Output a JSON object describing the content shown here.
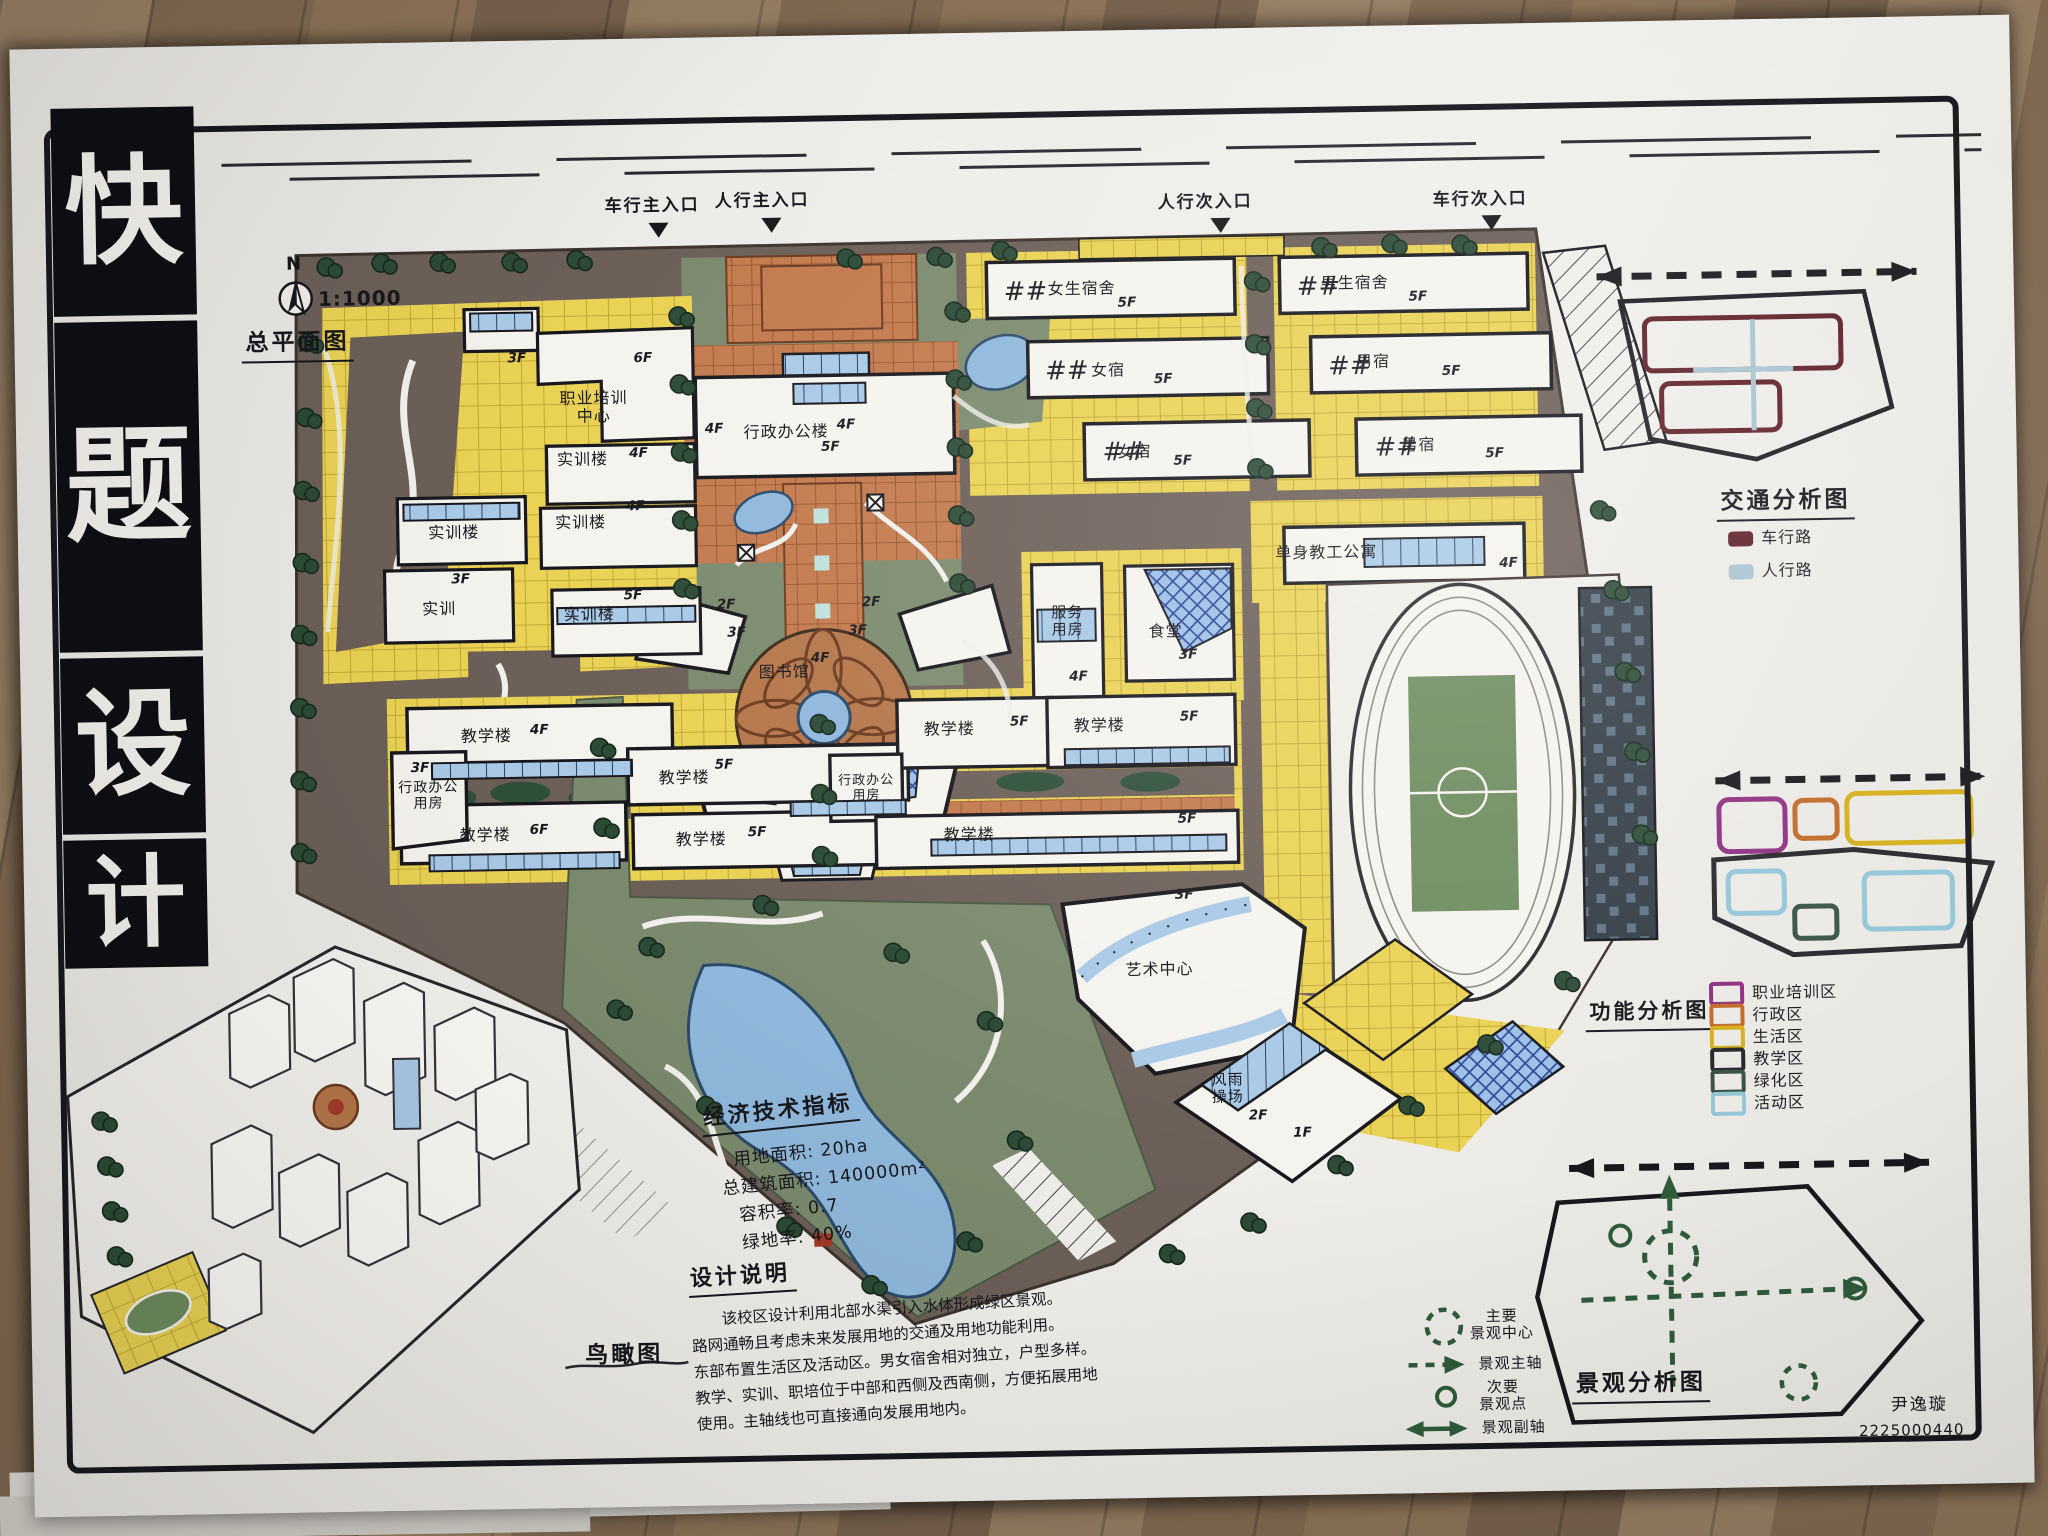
{
  "poster": {
    "vertical_title_chars": [
      "快",
      "题",
      "设",
      "计"
    ],
    "signature": {
      "name": "尹逸璇",
      "student_id": "2225000440"
    }
  },
  "master_plan": {
    "title": "总平面图",
    "north_label": "N",
    "scale": "1:1000",
    "entrances": [
      {
        "label": "车行主入口"
      },
      {
        "label": "人行主入口"
      },
      {
        "label": "人行次入口"
      },
      {
        "label": "车行次入口"
      }
    ],
    "buildings": [
      {
        "label": "职业培训\n中心",
        "floors": "6F"
      },
      {
        "label": "实训楼",
        "floors": "4F"
      },
      {
        "label": "实训楼",
        "floors": "4F"
      },
      {
        "label": "实训楼",
        "floors": "5F"
      },
      {
        "label": "实训楼",
        "floors": ""
      },
      {
        "label": "实训",
        "floors": "3F"
      },
      {
        "label": "行政办公楼",
        "floors": "5F"
      },
      {
        "label": "图书馆",
        "floors": "4F"
      },
      {
        "label": "女生宿舍",
        "floors": "5F"
      },
      {
        "label": "女宿",
        "floors": "5F"
      },
      {
        "label": "女宿",
        "floors": "5F"
      },
      {
        "label": "男生宿舍",
        "floors": "5F"
      },
      {
        "label": "男宿",
        "floors": "5F"
      },
      {
        "label": "男宿",
        "floors": "5F"
      },
      {
        "label": "服务\n用房",
        "floors": "4F"
      },
      {
        "label": "食堂",
        "floors": "3F"
      },
      {
        "label": "单身教工公寓",
        "floors": "4F"
      },
      {
        "label": "教学楼",
        "floors": "4F"
      },
      {
        "label": "行政办公\n用房",
        "floors": "3F"
      },
      {
        "label": "教学楼",
        "floors": "6F"
      },
      {
        "label": "教学楼",
        "floors": "5F"
      },
      {
        "label": "教学楼",
        "floors": "5F"
      },
      {
        "label": "教学楼",
        "floors": "5F"
      },
      {
        "label": "教学楼",
        "floors": "5F"
      },
      {
        "label": "行政办公\n用房",
        "floors": ""
      },
      {
        "label": "教学楼",
        "floors": "5F"
      },
      {
        "label": "艺术中心",
        "floors": "3F"
      },
      {
        "label": "风雨\n操场",
        "floors": "2F"
      }
    ],
    "extra_floor_tags": [
      "3F",
      "4F",
      "4F",
      "2F",
      "2F",
      "3F",
      "3F",
      "1F"
    ]
  },
  "diagrams": {
    "traffic": {
      "title": "交通分析图",
      "legend": [
        {
          "label": "车行路",
          "color": "#5e1f28"
        },
        {
          "label": "人行路",
          "color": "#a8c4cf"
        }
      ]
    },
    "function": {
      "title": "功能分析图",
      "legend": [
        {
          "label": "职业培训区",
          "color": "#8e2f80"
        },
        {
          "label": "行政区",
          "color": "#c06a28"
        },
        {
          "label": "生活区",
          "color": "#d4af1a"
        },
        {
          "label": "教学区",
          "color": "#26262b"
        },
        {
          "label": "绿化区",
          "color": "#375243"
        },
        {
          "label": "活动区",
          "color": "#93c5d8"
        }
      ]
    },
    "landscape": {
      "title": "景观分析图",
      "legend": [
        {
          "label": "主要\n景观中心"
        },
        {
          "label": "景观主轴"
        },
        {
          "label": "次要\n景观点"
        },
        {
          "label": "景观副轴"
        }
      ]
    }
  },
  "bird_view": {
    "title": "鸟瞰图"
  },
  "indicators": {
    "title": "经济技术指标",
    "items": [
      "用地面积: 20ha",
      "总建筑面积: 140000m²",
      "容积率: 0.7",
      "绿地率: 40%"
    ]
  },
  "description": {
    "title": "设计说明",
    "lines": [
      "该校区设计利用北部水渠引入水体形成绿区景观。",
      "路网通畅且考虑未来发展用地的交通及用地功能利用。",
      "东部布置生活区及活动区。男女宿舍相对独立，户型多样。",
      "教学、实训、职培位于中部和西侧及西南侧，方便拓展用地",
      "使用。主轴线也可直接通向发展用地内。"
    ]
  },
  "palette": {
    "wood": "#8a7258",
    "paper": "#efede9",
    "road": "#6c5f58",
    "paving": "#e9d254",
    "brick": "#c3794d",
    "green": "#7b8a6e",
    "tree": "#2c4a36",
    "water": "#8fb8dc",
    "building": "#f5f3ee",
    "window": "#a9c9e6"
  }
}
